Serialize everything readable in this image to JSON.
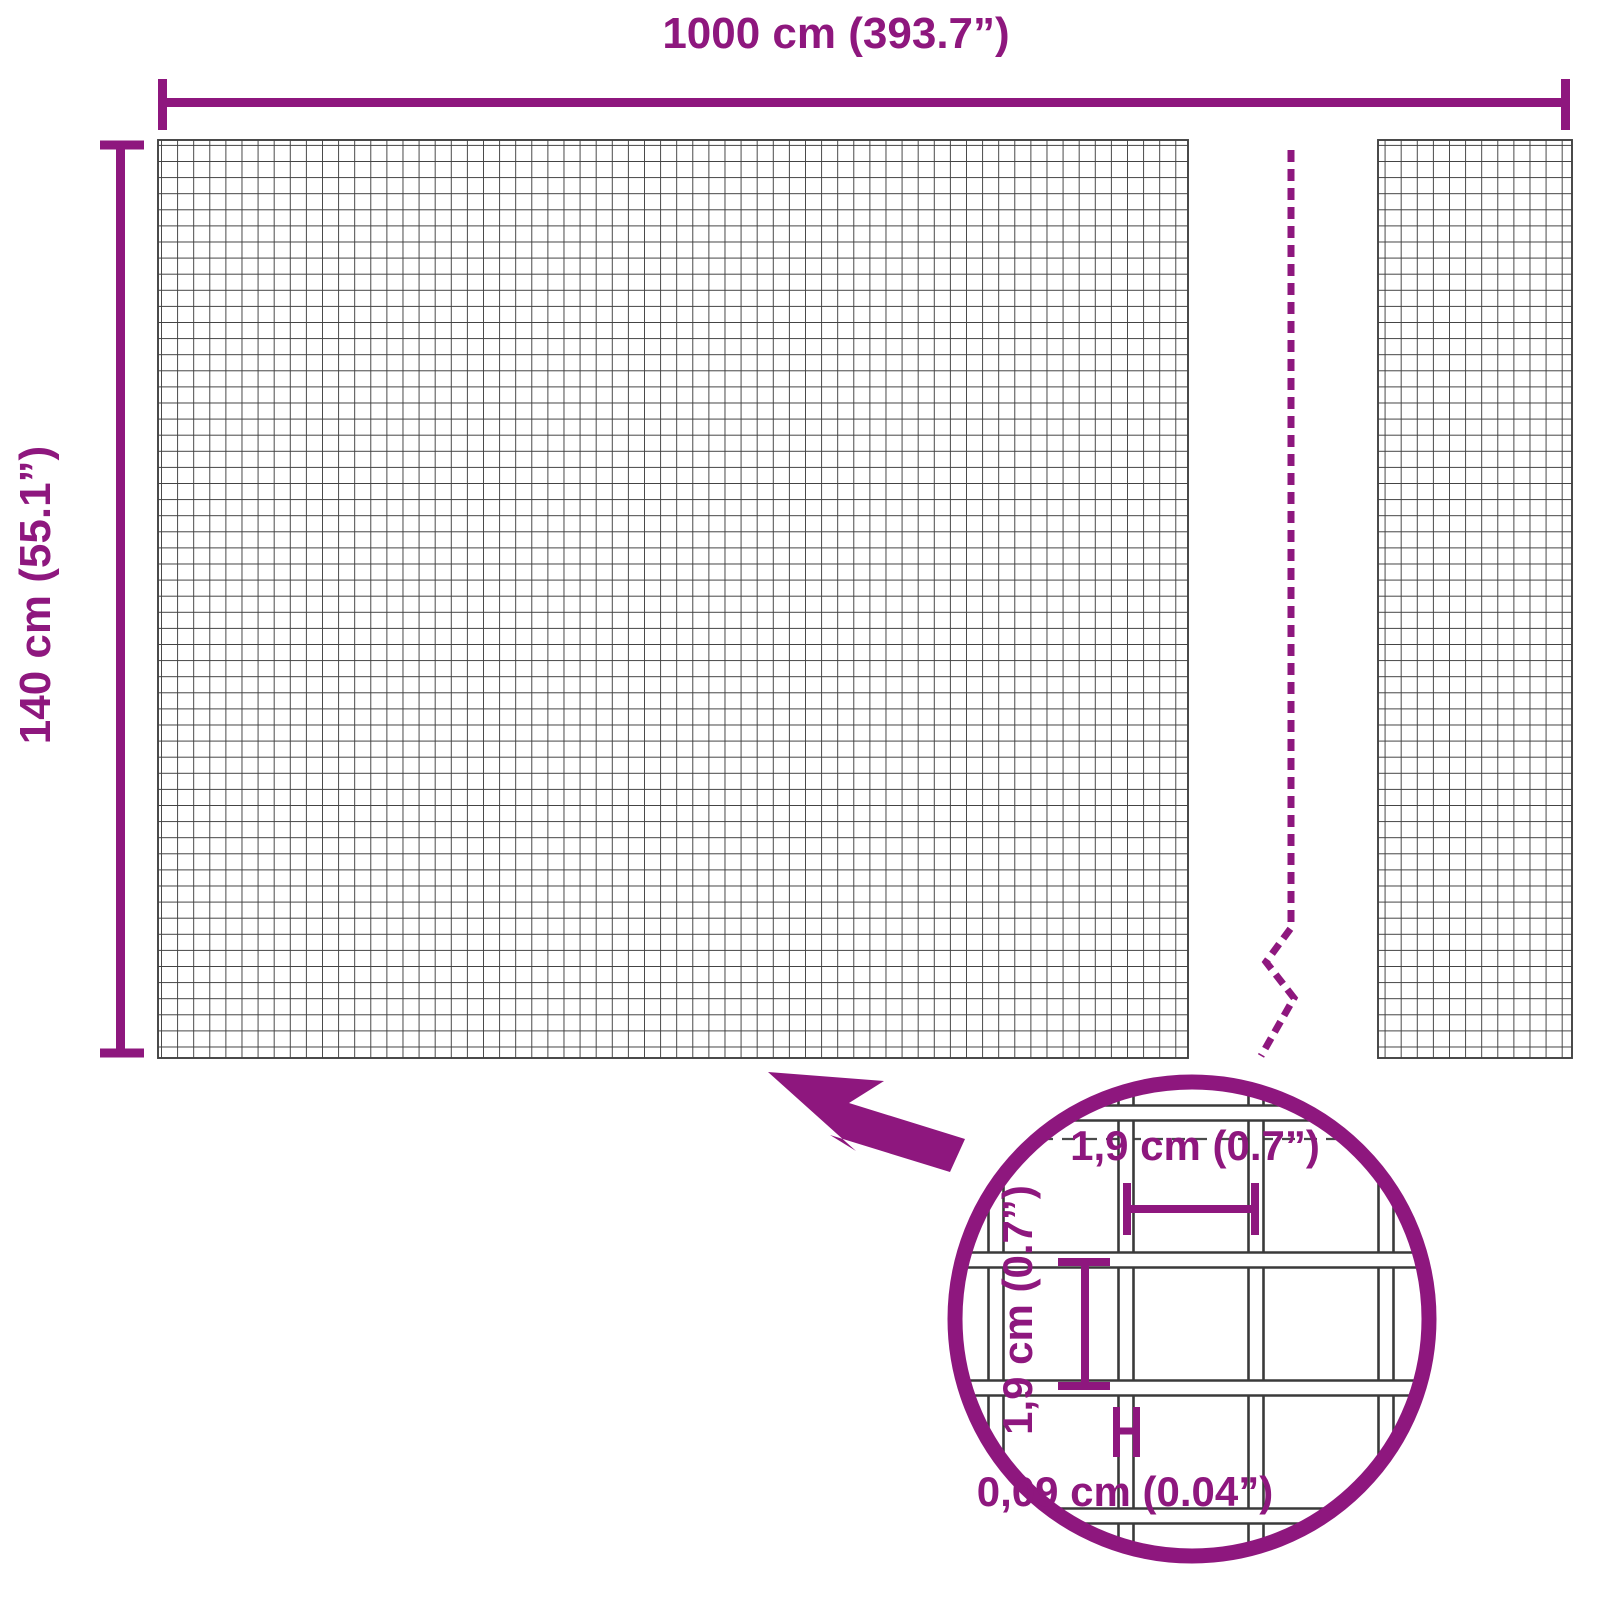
{
  "diagram": {
    "title": "wire mesh panel dimension diagram",
    "width_label": "1000 cm (393.7”)",
    "height_label": "140 cm (55.1”)",
    "detail": {
      "mesh_cell_width_label": "1,9 cm (0.7”)",
      "mesh_cell_height_label": "1,9 cm (0.7”)",
      "wire_thickness_label": "0,09 cm (0.04”)"
    },
    "colors": {
      "accent": "#8E177E",
      "grid": "#414141"
    }
  }
}
